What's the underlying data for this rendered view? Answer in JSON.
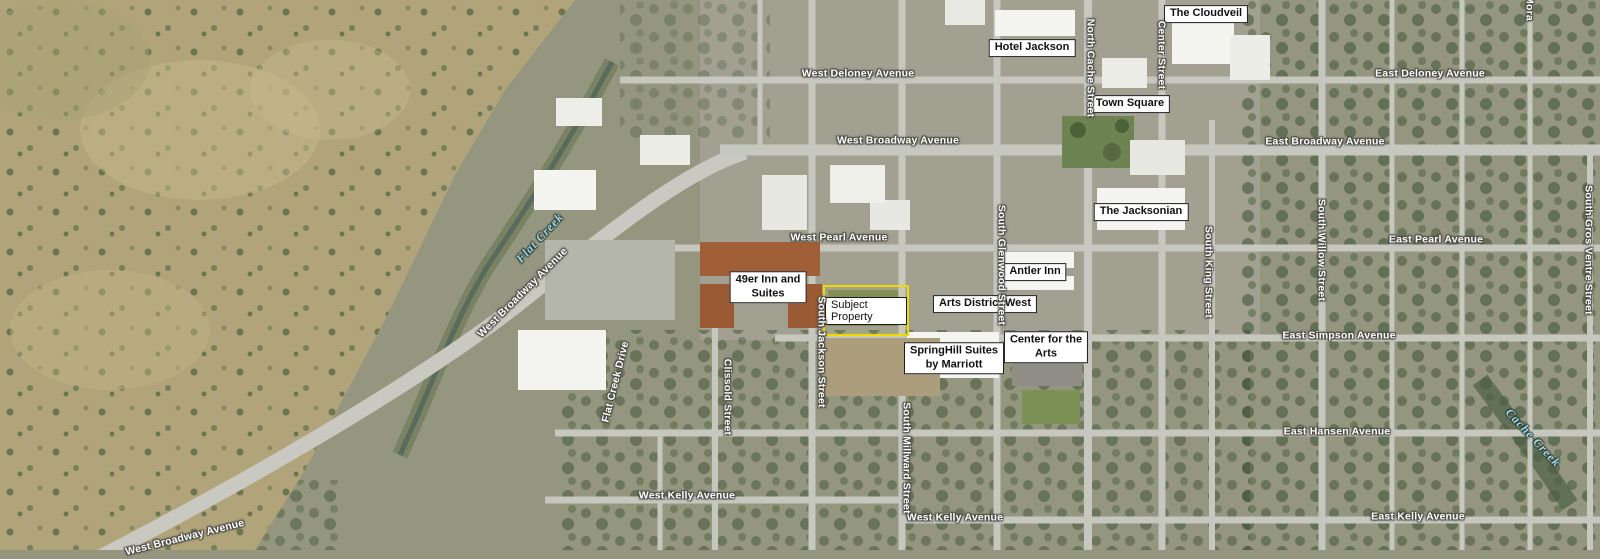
{
  "map": {
    "description": "Aerial exhibit map of downtown Jackson with labeled landmarks and streets",
    "colors": {
      "landmark_box_bg": "#ffffff",
      "landmark_box_border": "#1a1a1a",
      "landmark_text": "#111111",
      "street_text": "#ffffff",
      "street_halo": "#4a4a44",
      "water_text": "#9fdbe4",
      "subject_highlight": "#f0d900"
    },
    "landmarks": [
      {
        "label": "The Cloudveil",
        "x": 1206,
        "y": 14
      },
      {
        "label": "Hotel Jackson",
        "x": 1032,
        "y": 48
      },
      {
        "label": "Town Square",
        "x": 1130,
        "y": 104
      },
      {
        "label": "The Jacksonian",
        "x": 1141,
        "y": 212
      },
      {
        "label": "Antler Inn",
        "x": 1035,
        "y": 272
      },
      {
        "label": "49er Inn and\nSuites",
        "x": 768,
        "y": 287
      },
      {
        "label": "Arts District West",
        "x": 985,
        "y": 304
      },
      {
        "label": "SpringHill Suites\nby Marriott",
        "x": 954,
        "y": 358
      },
      {
        "label": "Center for the\nArts",
        "x": 1046,
        "y": 347
      }
    ],
    "streets": [
      {
        "label": "West Deloney Avenue",
        "x": 858,
        "y": 74,
        "rotate": 0
      },
      {
        "label": "East Deloney Avenue",
        "x": 1430,
        "y": 74,
        "rotate": 0
      },
      {
        "label": "West Broadway Avenue",
        "x": 898,
        "y": 141,
        "rotate": 0
      },
      {
        "label": "East Broadway Avenue",
        "x": 1325,
        "y": 142,
        "rotate": 0
      },
      {
        "label": "West Pearl Avenue",
        "x": 839,
        "y": 238,
        "rotate": 0
      },
      {
        "label": "East Pearl Avenue",
        "x": 1436,
        "y": 240,
        "rotate": 0
      },
      {
        "label": "East Simpson Avenue",
        "x": 1339,
        "y": 336,
        "rotate": 0
      },
      {
        "label": "East Hansen Avenue",
        "x": 1337,
        "y": 432,
        "rotate": 0
      },
      {
        "label": "West Kelly Avenue",
        "x": 687,
        "y": 496,
        "rotate": 0
      },
      {
        "label": "West Kelly Avenue",
        "x": 955,
        "y": 518,
        "rotate": 0
      },
      {
        "label": "East Kelly Avenue",
        "x": 1418,
        "y": 517,
        "rotate": 0
      },
      {
        "label": "West Broadway Avenue",
        "x": 523,
        "y": 293,
        "rotate": -45
      },
      {
        "label": "West Broadway Avenue",
        "x": 185,
        "y": 538,
        "rotate": -14
      },
      {
        "label": "Flat Creek Drive",
        "x": 616,
        "y": 382,
        "rotate": -76
      },
      {
        "label": "Clissold Street",
        "x": 727,
        "y": 397,
        "rotate": 90
      },
      {
        "label": "South Jackson Street",
        "x": 821,
        "y": 352,
        "rotate": 90
      },
      {
        "label": "South Millward Street",
        "x": 906,
        "y": 458,
        "rotate": 90
      },
      {
        "label": "South Glenwood Street",
        "x": 1001,
        "y": 265,
        "rotate": 90
      },
      {
        "label": "North Cache Street",
        "x": 1090,
        "y": 68,
        "rotate": 90
      },
      {
        "label": "Center Street",
        "x": 1161,
        "y": 55,
        "rotate": 90
      },
      {
        "label": "South King Street",
        "x": 1208,
        "y": 272,
        "rotate": 90
      },
      {
        "label": "South Willow Street",
        "x": 1321,
        "y": 250,
        "rotate": 90
      },
      {
        "label": "South Gros Ventre Street",
        "x": 1588,
        "y": 250,
        "rotate": 90
      },
      {
        "label": "Mora",
        "x": 1529,
        "y": 8,
        "rotate": 90
      }
    ],
    "waterways": [
      {
        "label": "Flat Creek",
        "x": 540,
        "y": 238,
        "rotate": -47
      },
      {
        "label": "Cache Creek",
        "x": 1533,
        "y": 438,
        "rotate": 47
      }
    ],
    "subject_property": {
      "label": "Subject Property",
      "x": 823,
      "y": 285,
      "w": 82,
      "h": 47,
      "highlight_color": "#f0d900"
    }
  }
}
